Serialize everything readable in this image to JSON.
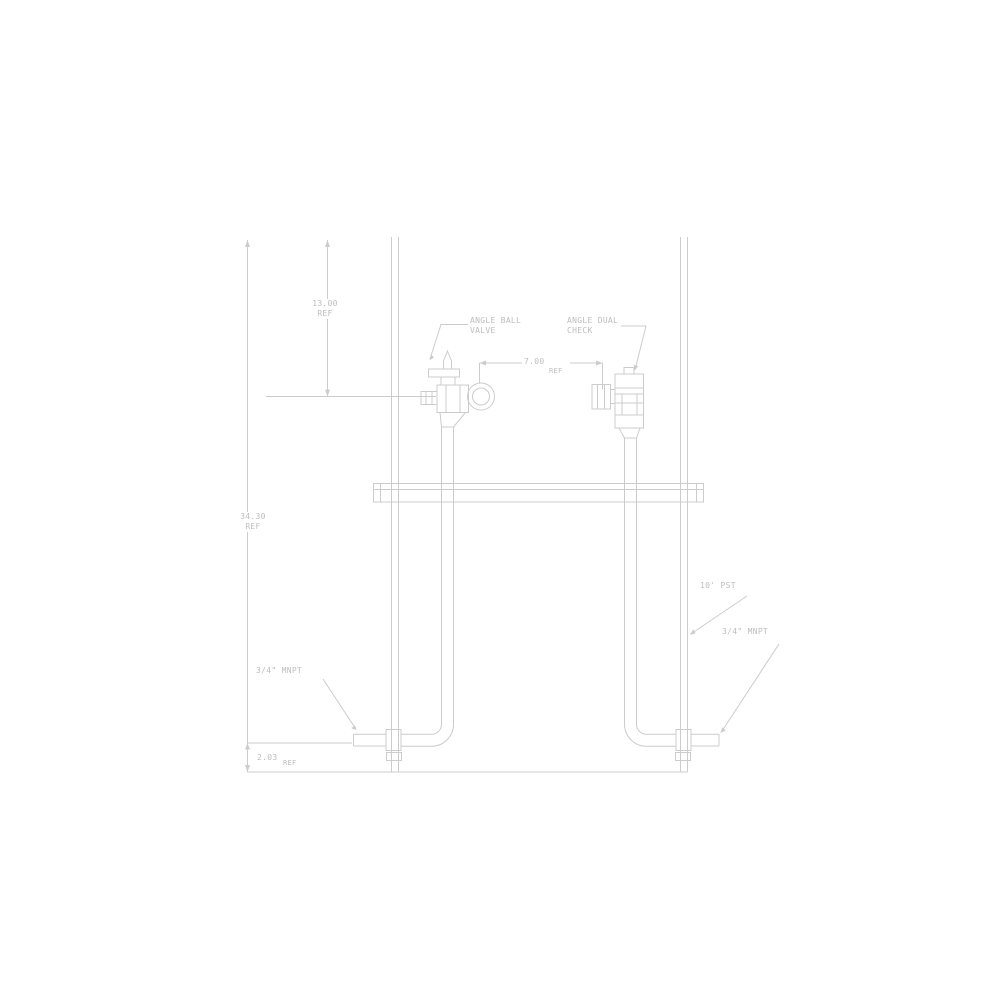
{
  "page": {
    "background": "#ffffff"
  },
  "drawing": {
    "type": "meter-setter-elevation-drawing",
    "line_color": "#cccccc",
    "text_color": "#bdbdbd",
    "callouts": {
      "angle_ball_valve": "ANGLE BALL\nVALVE",
      "angle_dual_check": "ANGLE DUAL\nCHECK",
      "inlet_thread": "3/4\" MNPT",
      "outlet_thread": "3/4\" MNPT",
      "support_tube": "10' PST"
    },
    "dimensions": {
      "valve_height": "13.00\nREF",
      "meter_spread": "7.00",
      "meter_spread_ref": "REF",
      "overall_height": "34.30\nREF",
      "base_offset": "2.03",
      "base_offset_ref": "REF"
    }
  }
}
